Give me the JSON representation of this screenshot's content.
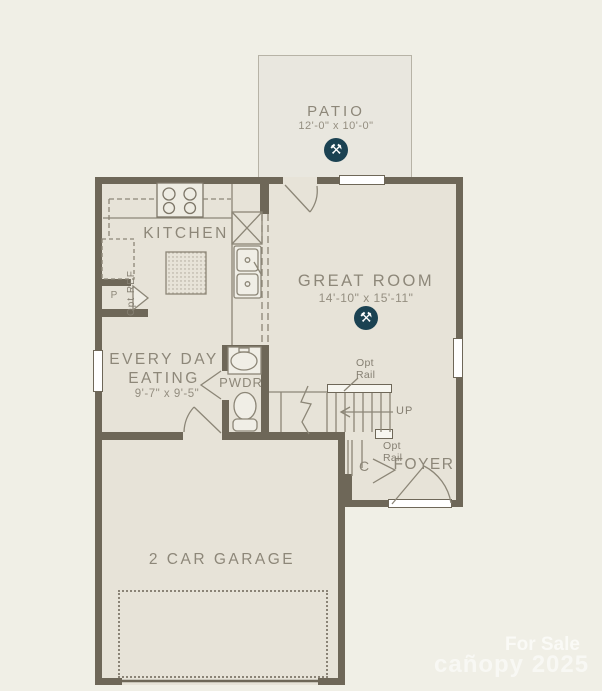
{
  "colors": {
    "background": "#f0efe6",
    "floor": "#e7e3d8",
    "patio_floor": "#e9e7df",
    "wall": "#6e6758",
    "line": "#8c8677",
    "text": "#8d8779",
    "marker_bg": "#1b4252"
  },
  "rooms": {
    "patio": {
      "label": "PATIO",
      "dims": "12'-0\" x 10'-0\""
    },
    "kitchen": {
      "label": "KITCHEN"
    },
    "great_room": {
      "label": "GREAT ROOM",
      "dims": "14'-10\" x 15'-11\""
    },
    "eating": {
      "label_line1": "EVERY DAY",
      "label_line2": "EATING",
      "dims": "9'-7\" x 9'-5\""
    },
    "powder": {
      "label": "PWDR"
    },
    "foyer": {
      "label": "FOYER"
    },
    "garage": {
      "label": "2 CAR GARAGE"
    },
    "closet": {
      "label": "C"
    },
    "pantry": {
      "label": "P"
    }
  },
  "annotations": {
    "up": "UP",
    "opt_rail_upper": {
      "line1": "Opt",
      "line2": "Rail"
    },
    "opt_rail_lower": {
      "line1": "Opt",
      "line2": "Rail"
    },
    "opt_ref": "Opt REF"
  },
  "icons": {
    "feature_marker_glyph": "⚒"
  },
  "watermark": {
    "line1": "For Sale",
    "line2": "cañopy 2025"
  }
}
